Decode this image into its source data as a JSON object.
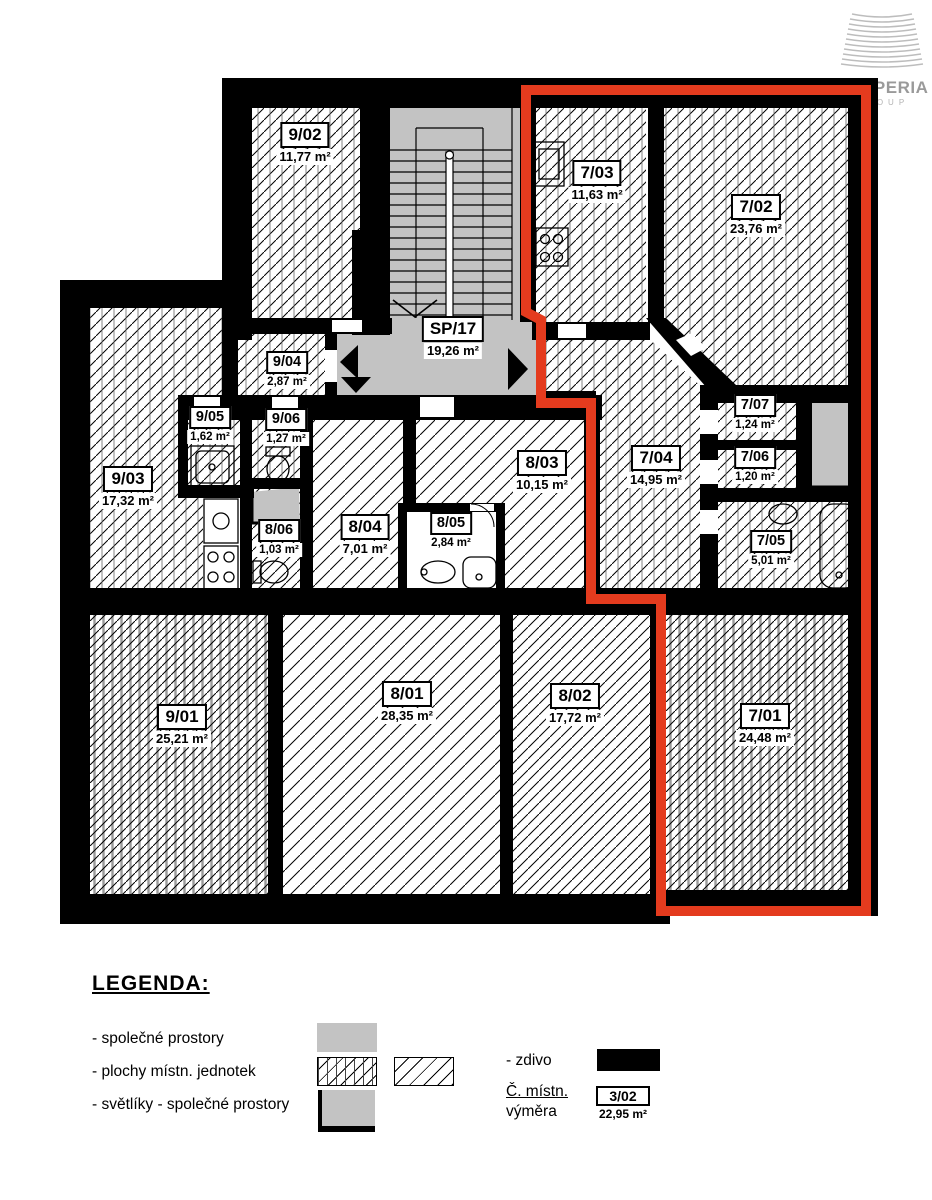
{
  "logo": {
    "brand": "PROPERIA",
    "sub": "GROUP"
  },
  "colors": {
    "red": "#e43b1e",
    "gray": "#c3c3c3",
    "wall": "#000000"
  },
  "rooms": [
    {
      "id": "9/02",
      "area": "11,77 m²"
    },
    {
      "id": "SP/17",
      "area": "19,26 m²"
    },
    {
      "id": "7/03",
      "area": "11,63 m²"
    },
    {
      "id": "7/02",
      "area": "23,76 m²"
    },
    {
      "id": "9/04",
      "area": "2,87 m²"
    },
    {
      "id": "9/05",
      "area": "1,62 m²"
    },
    {
      "id": "9/06",
      "area": "1,27 m²"
    },
    {
      "id": "9/03",
      "area": "17,32 m²"
    },
    {
      "id": "8/03",
      "area": "10,15 m²"
    },
    {
      "id": "7/04",
      "area": "14,95 m²"
    },
    {
      "id": "7/07",
      "area": "1,24 m²"
    },
    {
      "id": "7/06",
      "area": "1,20 m²"
    },
    {
      "id": "8/06",
      "area": "1,03 m²"
    },
    {
      "id": "8/04",
      "area": "7,01 m²"
    },
    {
      "id": "8/05",
      "area": "2,84 m²"
    },
    {
      "id": "7/05",
      "area": "5,01 m²"
    },
    {
      "id": "9/01",
      "area": "25,21 m²"
    },
    {
      "id": "8/01",
      "area": "28,35 m²"
    },
    {
      "id": "8/02",
      "area": "17,72 m²"
    },
    {
      "id": "7/01",
      "area": "24,48 m²"
    }
  ],
  "legend": {
    "title": "LEGENDA:",
    "items": [
      {
        "label": "- společné prostory"
      },
      {
        "label": "- plochy místn. jednotek"
      },
      {
        "label": "- světlíky - společné prostory"
      }
    ],
    "zdivo_label": "- zdivo",
    "room_no_label": "Č. místn.",
    "area_label": "výměra",
    "sample_id": "3/02",
    "sample_area": "22,95 m²"
  }
}
